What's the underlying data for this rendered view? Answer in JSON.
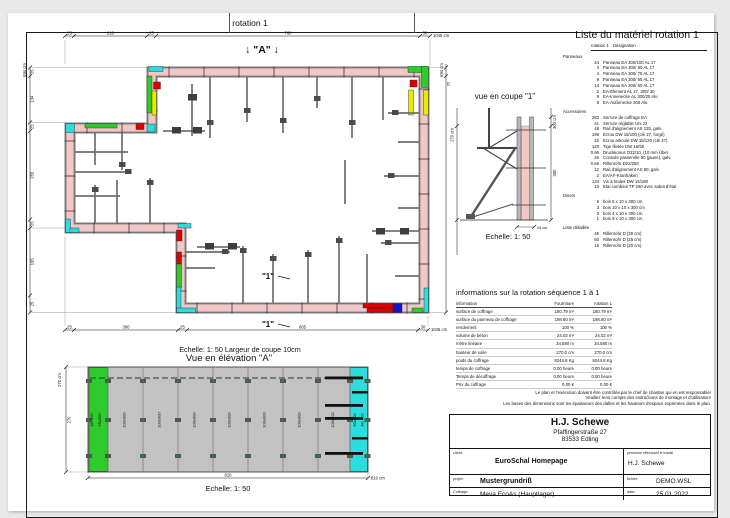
{
  "plan": {
    "title": "rotation 1",
    "marker_a": "↓ \"A\" ↓",
    "marker_1": "\"1\"",
    "scale_note": "Echelle: 1: 50   Largeur de coupe 10cm",
    "dims": {
      "top": [
        "25",
        "210",
        "25",
        "760",
        "30"
      ],
      "top_total": "1045 cm",
      "bottom": [
        "25",
        "300",
        "25",
        "665",
        "30"
      ],
      "bottom_total": "1045 cm",
      "left": [
        "25",
        "134",
        "25",
        "255",
        "25",
        "195",
        "25"
      ],
      "left_total": "694 cm",
      "right": [
        "26"
      ],
      "right_total": "694 cm"
    }
  },
  "section": {
    "title": "vue en coupe \"1\"",
    "scale": "Echelle: 1: 50",
    "dim_left_total": "270 cm",
    "dim_right_total": "300 cm",
    "dim_right_seg": "300",
    "dim_bottom": "25 cm"
  },
  "elevation": {
    "title": "Vue en élévation \"A\"",
    "scale": "Echelle: 1: 50",
    "dim_left_total": "270 cm",
    "dim_left_seg": "270",
    "dim_bottom_seg": "810",
    "dim_bottom_total": "810 cm",
    "panel_labels_left": [
      "AE 300",
      "55x300"
    ],
    "panel_labels_mid": [
      "100x300",
      "100x300",
      "100x300",
      "100x300",
      "100x300",
      "100x300",
      "100x300"
    ],
    "panel_labels_right": [
      "50x300",
      "AE 300"
    ]
  },
  "material_list": {
    "title": "Liste du matériel  rotation 1",
    "col1": "rotation 1",
    "col2": "Désignation",
    "sections": [
      {
        "name": "Panneaux",
        "items": [
          [
            "44",
            "Panneau EA 300/100 AL 17"
          ],
          [
            "4",
            "Panneau EA 300/ 80 AL 17"
          ],
          [
            "4",
            "Panneau EA 300/ 75 AL 17"
          ],
          [
            "8",
            "Panneau EA 300/ 55 AL 17"
          ],
          [
            "14",
            "Panneau EA 300/ 50 AL 17"
          ],
          [
            "2",
            "EA-Element AL 17, 300/ 30"
          ],
          [
            "8",
            "EA-Innenecke AL 300/25 Alu"
          ],
          [
            "8",
            "EA-Außenecke 300 Alu"
          ]
        ]
      },
      {
        "name": "Accessoires",
        "items": [
          [
            "283",
            "Serrure de coffrage EA"
          ],
          [
            "41",
            "Serrure réglable Uni 22"
          ],
          [
            "48",
            "Rail d'alignement AS 125, galv."
          ],
          [
            "198",
            "Ecrou DW 15/100 (clé 27, forgé)"
          ],
          [
            "42",
            "Ecrou articulé DW 15/120 (clé 27)"
          ],
          [
            "120",
            "Tige filetée DW 15/50"
          ],
          [
            "0.96",
            "Druckkonus D22/10, (10 mm Über"
          ],
          [
            "26",
            "Console passerelle 90 (jaune), galv."
          ],
          [
            "0.66",
            "Rillenrohr D22/250"
          ],
          [
            "12",
            "Rail d'alignement AS 50, galv."
          ],
          [
            "2",
            "EA/AF-Kranhaken"
          ],
          [
            "134",
            "Vis à brides DW 15/180"
          ],
          [
            "13",
            "Etai combiné TP 250 avec sabot d'étai"
          ]
        ]
      },
      {
        "name": "Divers",
        "items": [
          [
            "5",
            "bois 5 x 10 x 300 cm"
          ],
          [
            "3",
            "bois 10 x 10 x 300 cm"
          ],
          [
            "3",
            "bois 4 x 10 x 300 cm"
          ],
          [
            "1",
            "bois 9 x 10 x 300 cm"
          ]
        ]
      },
      {
        "name": "Liste détaillée",
        "items": [
          [
            "45",
            "Rillenrohr D (30 cm)"
          ],
          [
            "50",
            "Rillenrohr D (25 cm)"
          ],
          [
            "15",
            "Rillenrohr D (20 cm)"
          ]
        ]
      }
    ]
  },
  "info_table": {
    "title": "informations sur la rotation  séquence 1 à 1",
    "headers": [
      "information",
      "Fourniture",
      "rotation 1"
    ],
    "rows": [
      [
        "surface de coffrage",
        "180.79 m²",
        "180.79 m²"
      ],
      [
        "surface du panneau de coffrage",
        "198.60 m²",
        "198.60 m²"
      ],
      [
        "rendement",
        "100 %",
        "100 %"
      ],
      [
        "volume de béton",
        "24.02 m³",
        "24.02 m³"
      ],
      [
        "mètre linéaire",
        "34.580 m",
        "34.580 m"
      ],
      [
        "hauteur de voile",
        "270.0 cm",
        "270.0 cm"
      ],
      [
        "poids du coffrage",
        "9244.8 Kg",
        "9244.8 Kg"
      ],
      [
        "temps de coffrage",
        "0.00 heure",
        "0.00 heure"
      ],
      [
        "Temps de décoffrage",
        "0.00 heure",
        "0.00 heure"
      ],
      [
        "Prix du coffrage",
        "0.00 €",
        "0.00 €"
      ]
    ]
  },
  "disclaimer": [
    "Le plan et l'exécution doivent être contrôlés par le chef de chantier qui en est responsable!",
    "Veuillez tenir compte des instructions de montage et d'utilisation!",
    "Les bases des dimensions sont les épaisseurs des dalles et les hauteurs d'espace exprimées dans le plan."
  ],
  "title_block": {
    "company_name": "H.J. Schewe",
    "address1": "Pfaffingerstraße 27",
    "address2": "83533 Edling",
    "client_label": "client:",
    "client_value": "EuroSchal Homepage",
    "worker_label": "personne effectuant le travail",
    "worker_value": "H.J. Schewe",
    "project_label": "projet:",
    "project_value": "Mustergrundriß",
    "file_label": "fichier:",
    "file_value": "DEMO.WSL",
    "formwork_label": "Coffrage:",
    "formwork_value": "Meva EcoAs (Hauptlager)",
    "date_label": "date:",
    "date_value": "25.01.2022"
  },
  "colors": {
    "wall_pink": "#f4c7c7",
    "rail_gray": "#989898",
    "rail_dark": "#4a4a4a",
    "piece_red": "#dd0000",
    "piece_green": "#2ccc2c",
    "piece_cyan": "#2cdddd",
    "piece_yellow": "#ebeb00",
    "piece_blue": "#1414cc",
    "elev_gray": "#c2c2c2"
  }
}
